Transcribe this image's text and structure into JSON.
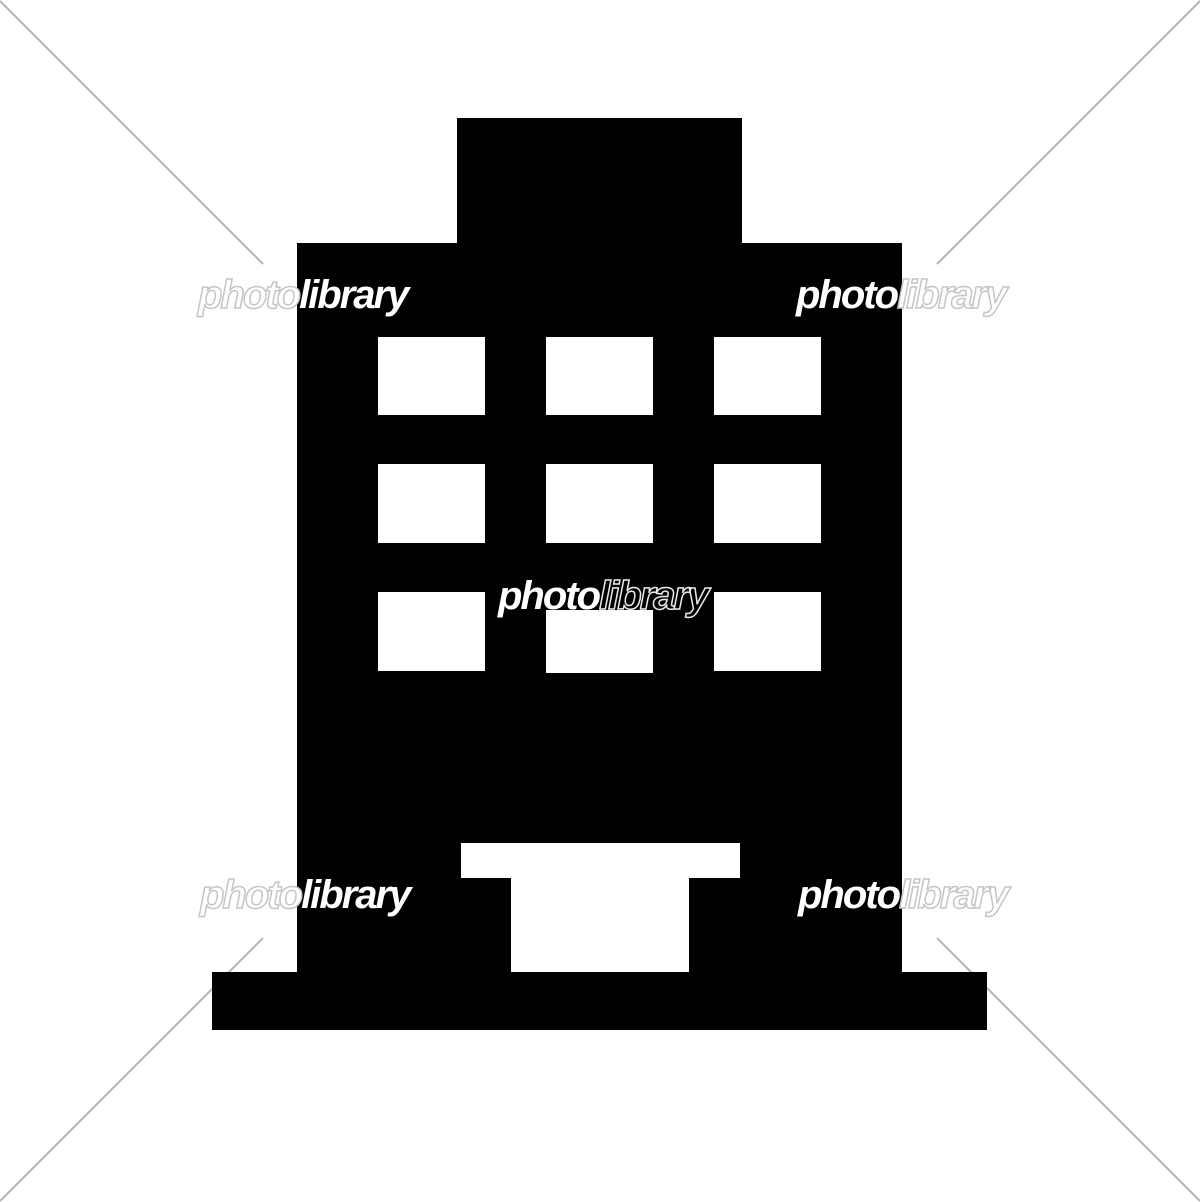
{
  "meta": {
    "subject": "office-building-icon",
    "background_color": "#ffffff",
    "icon_color": "#000000",
    "watermark_line_color": "#b4b4b4",
    "watermark_outline_color": "#c5c5c5"
  },
  "watermarks": [
    {
      "position": "top-left",
      "part1": "photo",
      "part2": "library"
    },
    {
      "position": "top-right",
      "part1": "photo",
      "part2": "library"
    },
    {
      "position": "center",
      "part1": "photo",
      "part2": "library"
    },
    {
      "position": "bottom-left",
      "part1": "photo",
      "part2": "library"
    },
    {
      "position": "bottom-right",
      "part1": "photo",
      "part2": "library"
    }
  ]
}
